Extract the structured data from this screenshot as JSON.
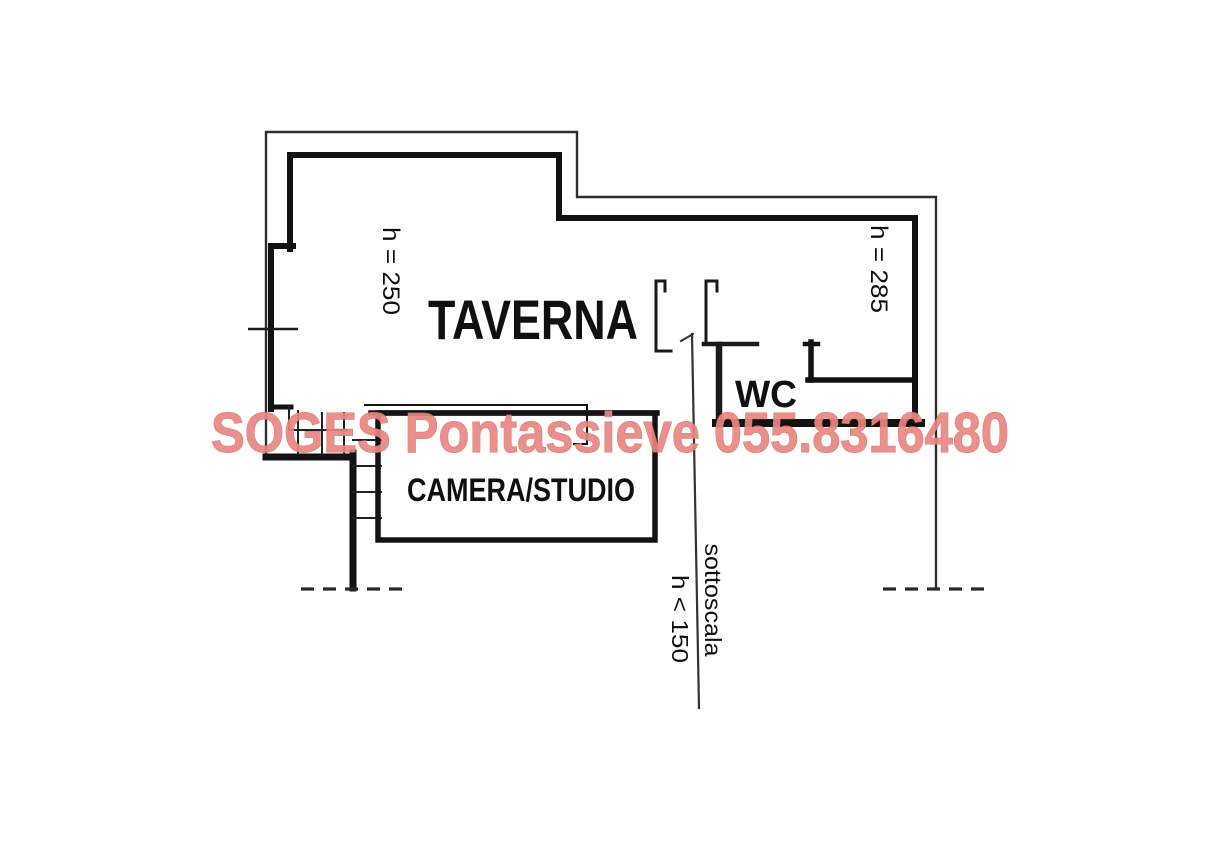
{
  "floor_plan": {
    "rooms": {
      "taverna": {
        "label": "TAVERNA",
        "height_label": "h = 250"
      },
      "camera_studio": {
        "label": "CAMERA/STUDIO"
      },
      "wc": {
        "label": "WC"
      },
      "right_room": {
        "height_label": "h = 285"
      },
      "understairs": {
        "label": "sottoscala",
        "height_label": "h < 150"
      }
    }
  },
  "watermark": {
    "text": "SOGES Pontassieve 055.8316480",
    "color": "#e9867f"
  },
  "colors": {
    "wall": "#141414",
    "outer_wall": "#2e2e2e",
    "background": "#ffffff"
  }
}
